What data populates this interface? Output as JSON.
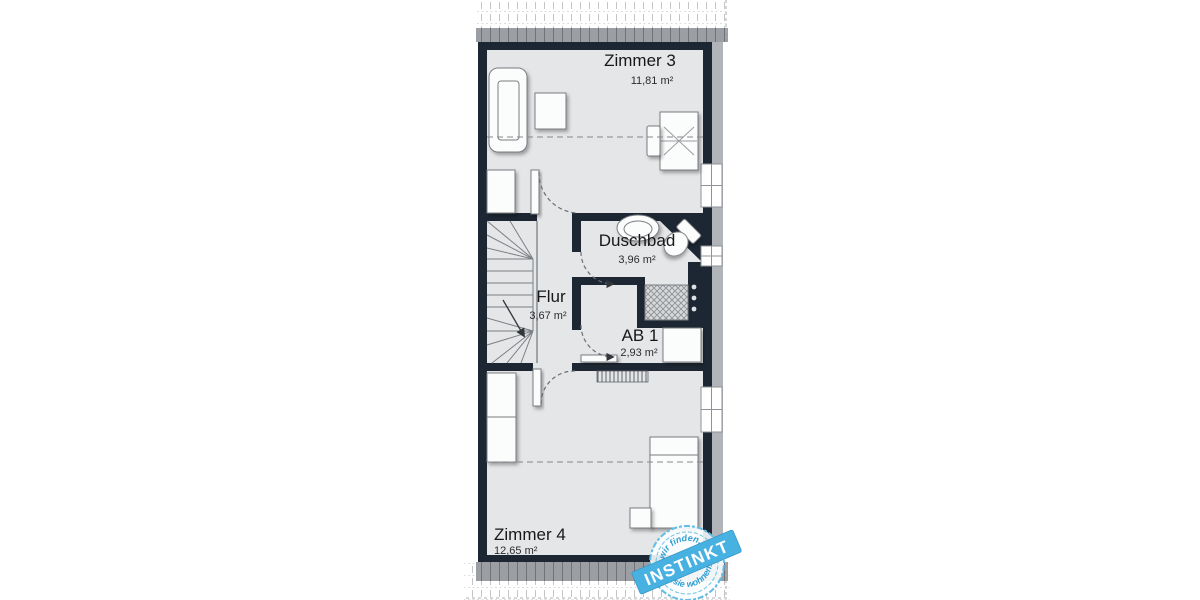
{
  "floorplan": {
    "colors": {
      "wall": "#1d2734",
      "floor": "#e4e6e8",
      "roof_band": "#9b9ea3",
      "outer_shadow": "#b1b4b8",
      "furniture_outline": "#7a7d81",
      "stamp_ribbon_blue": "#47b1e2",
      "stamp_text_blue": "#2f9fd3"
    },
    "rooms": [
      {
        "name": "Zimmer 3",
        "area": "11,81 m²"
      },
      {
        "name": "Duschbad",
        "area": "3,96 m²"
      },
      {
        "name": "Flur",
        "area": "3,67 m²"
      },
      {
        "name": "AB 1",
        "area": "2,93 m²"
      },
      {
        "name": "Zimmer 4",
        "area": "12,65 m²"
      }
    ],
    "stamp": {
      "arc_top": "wir finden...",
      "brand": "INSTINKT",
      "arc_bottom": "...sie wohnen!"
    }
  }
}
